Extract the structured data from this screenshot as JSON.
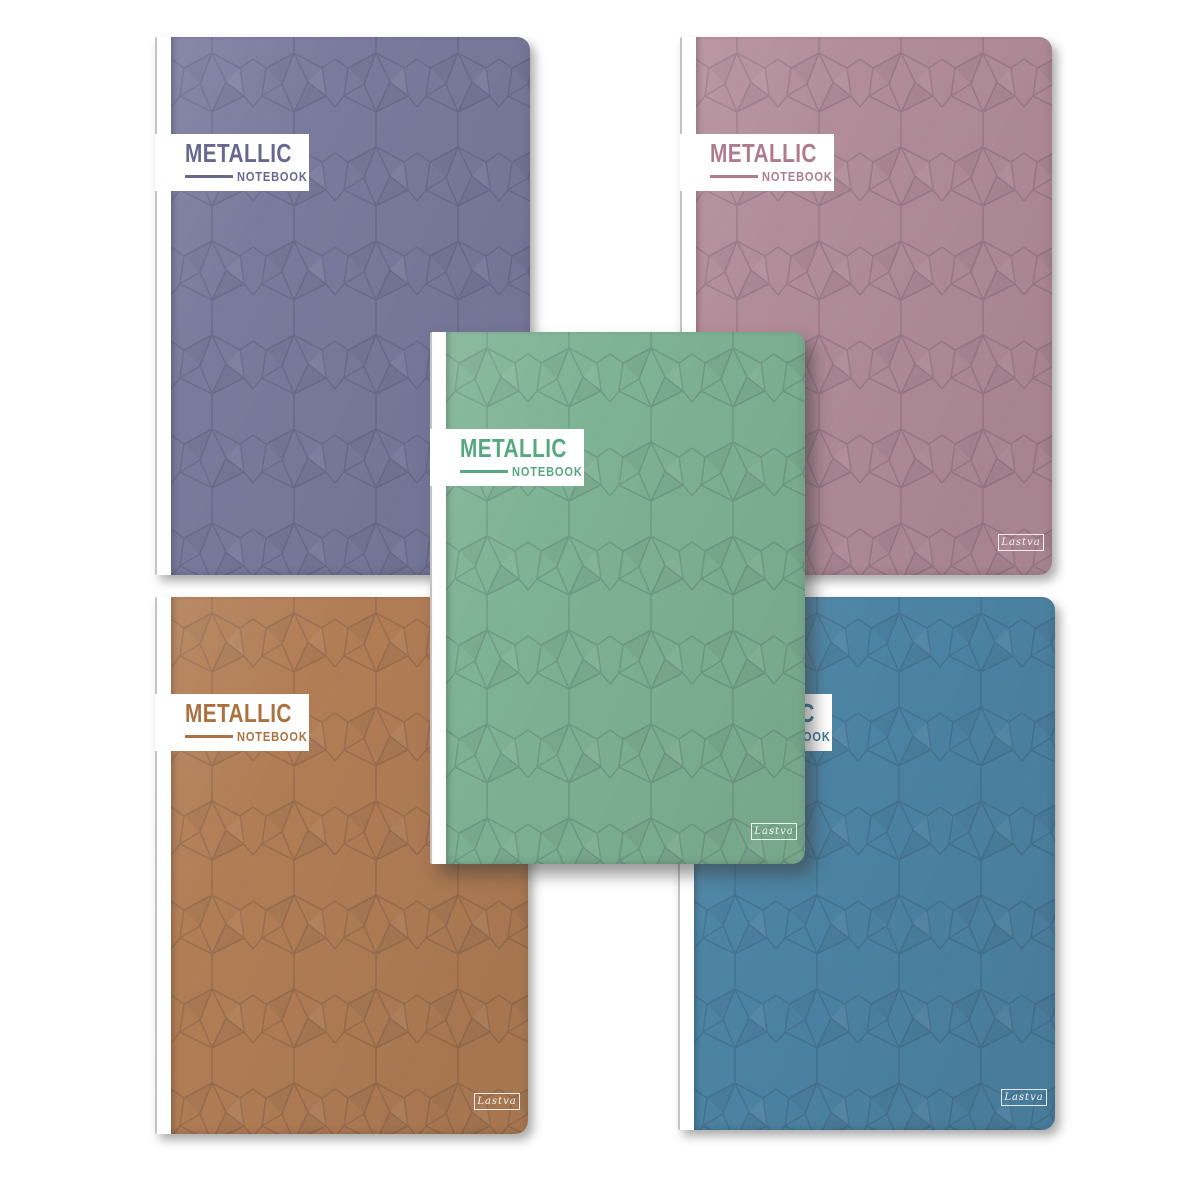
{
  "page": {
    "background_color": "#ffffff"
  },
  "product": {
    "title": "METALLIC",
    "subtitle": "NOTEBOOK",
    "brand_signature": "Lastva"
  },
  "notebooks": [
    {
      "name": "purple",
      "title": "METALLIC",
      "subtitle": "NOTEBOOK",
      "signature": "Lastva",
      "base_color": "#7a7a9e",
      "label_text_color": "#68688f"
    },
    {
      "name": "mauve",
      "title": "METALLIC",
      "subtitle": "NOTEBOOK",
      "signature": "Lastva",
      "base_color": "#b28c99",
      "label_text_color": "#af7c8f"
    },
    {
      "name": "green",
      "title": "METALLIC",
      "subtitle": "NOTEBOOK",
      "signature": "Lastva",
      "base_color": "#7fb395",
      "label_text_color": "#55a881"
    },
    {
      "name": "copper",
      "title": "METALLIC",
      "subtitle": "NOTEBOOK",
      "signature": "Lastva",
      "base_color": "#b17d55",
      "label_text_color": "#ac713f"
    },
    {
      "name": "blue",
      "title": "METALLIC",
      "subtitle": "NOTEBOOK",
      "signature": "Lastva",
      "base_color": "#4d84a4",
      "label_text_color": "#3b7898"
    }
  ],
  "pattern": {
    "style": "geometric-facets",
    "line_color": "rgba(20,20,45,0.14)"
  }
}
